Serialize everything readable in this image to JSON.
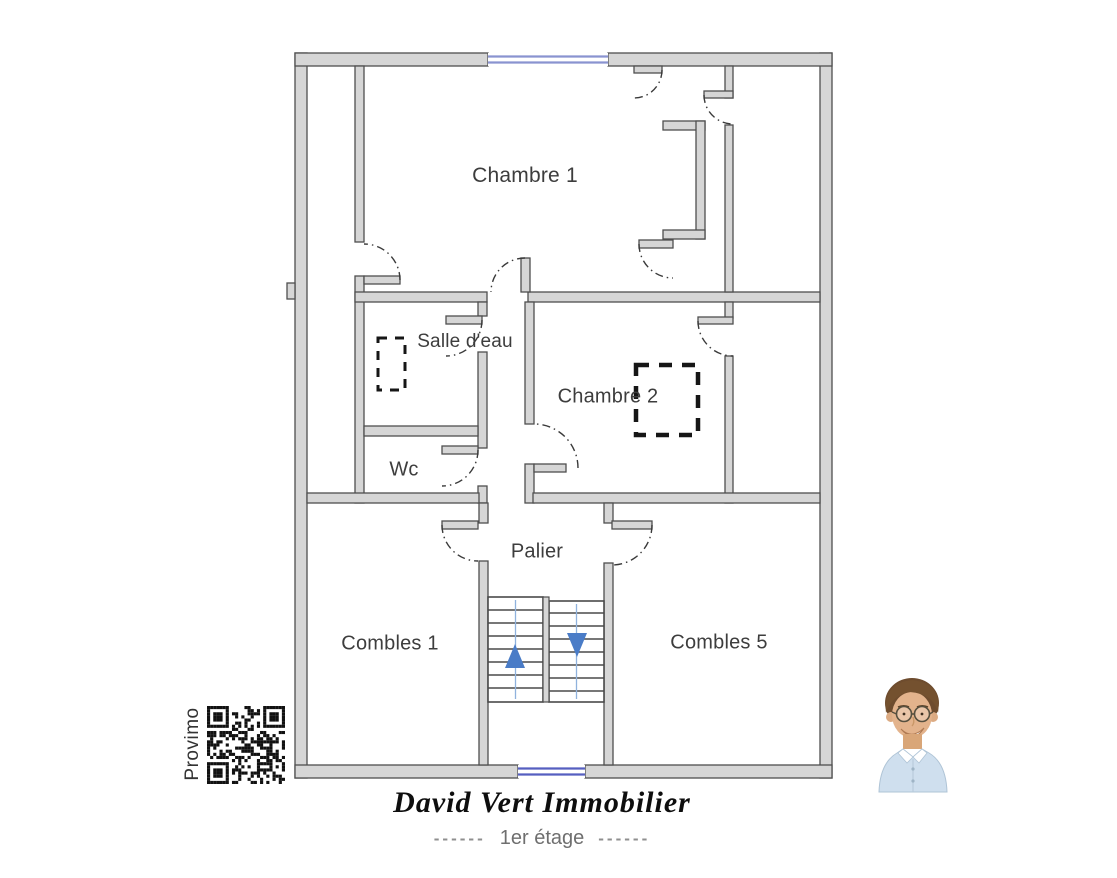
{
  "plan": {
    "rooms": {
      "chambre1": "Chambre 1",
      "salle_deau": "Salle d'eau",
      "wc": "Wc",
      "chambre2": "Chambre 2",
      "palier": "Palier",
      "combles1": "Combles 1",
      "combles5": "Combles 5"
    },
    "features": {
      "stairs_up_icon": "up-arrow",
      "stairs_down_icon": "down-arrow",
      "window_icon": "window-double-blue-line",
      "door_icon": "door-swing-arc",
      "skylight_icon": "dashed-outline"
    }
  },
  "branding": {
    "provider": "Provimo",
    "qr_icon": "qr-code",
    "agent_photo_icon": "agent-portrait",
    "agency_name": "David Vert Immobilier",
    "floor_dash_left": "------",
    "floor_label": "1er étage",
    "floor_dash_right": "------"
  },
  "colors": {
    "wall_fill": "#d6d6d6",
    "wall_stroke": "#4f4f4f",
    "window_blue_top": "#8a93d0",
    "window_blue_bottom": "#565fc0",
    "stair_arrow_blue": "#4a7cc7",
    "stair_guide_blue": "#90b2dd",
    "label_text": "#3d3d3d",
    "caption_gray": "#6f6f6f"
  }
}
